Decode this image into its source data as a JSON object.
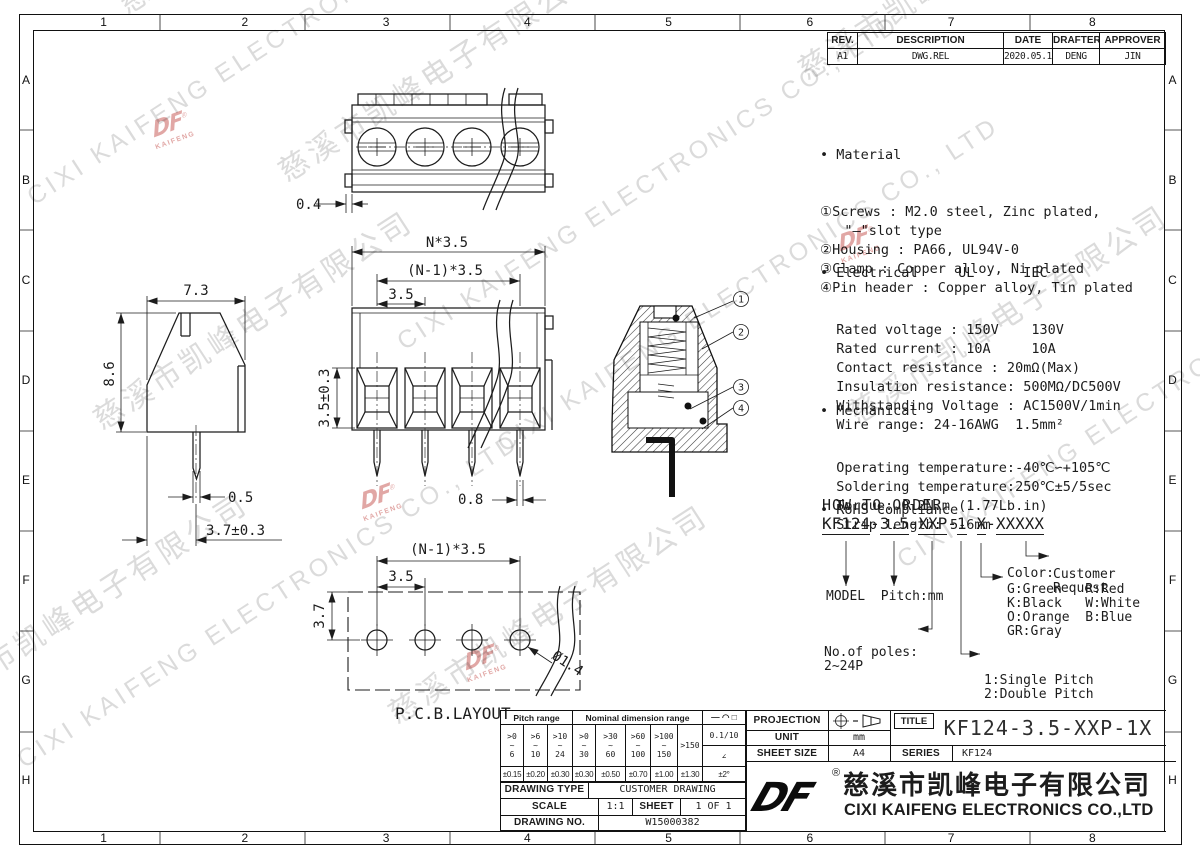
{
  "zones": {
    "cols": [
      "1",
      "2",
      "3",
      "4",
      "5",
      "6",
      "7",
      "8"
    ],
    "rows": [
      "A",
      "B",
      "C",
      "D",
      "E",
      "F",
      "G",
      "H"
    ]
  },
  "revision_table": {
    "headers": [
      "REV.",
      "DESCRIPTION",
      "DATE",
      "DRAFTER",
      "APPROVER"
    ],
    "row": [
      "A1",
      "DWG.REL",
      "2020.05.19",
      "DENG",
      "JIN"
    ]
  },
  "notes": {
    "material": {
      "title": "• Material",
      "lines": [
        "①Screws : M2.0 steel, Zinc plated,",
        "   \"—\"slot type",
        "②Housing : PA66, UL94V-0",
        "③Clamp : Copper alloy, Ni plated",
        "④Pin header : Copper alloy, Tin plated"
      ]
    },
    "electrical": {
      "title": "• Electrical     UL      IEC",
      "lines": [
        "  Rated voltage : 150V    130V",
        "  Rated current : 10A     10A",
        "  Contact resistance : 20mΩ(Max)",
        "  Insulation resistance: 500MΩ/DC500V",
        "  Withstanding Voltage : AC1500V/1min",
        "  Wire range: 24-16AWG  1.5mm²"
      ]
    },
    "mechanical": {
      "title": "• Mechanical",
      "lines": [
        "  Operating temperature:-40℃∽+105℃",
        "  Soldering temperature:250℃±5/5sec",
        "  Torque: 0.2N.m (1.77Lb.in)",
        "  Strip length: 5-6mm"
      ]
    },
    "rohs": "• RoHS compliance"
  },
  "how_to_order": {
    "title": "HOW TO ORDER",
    "code": [
      "KF124",
      "-",
      "3.5",
      "-",
      "XXP",
      "-",
      "1",
      "X",
      "-",
      "XXXXX"
    ],
    "model_pitch": "MODEL  Pitch:mm",
    "poles_line1": "No.of poles:",
    "poles_line2": "2~24P",
    "pitch_line1": "1:Single Pitch",
    "pitch_line2": "2:Double Pitch",
    "color_title": "Color:",
    "color_lines": [
      "G:Green   R:Red",
      "K:Black   W:White",
      "O:Orange  B:Blue",
      "GR:Gray"
    ],
    "customer_line1": "Customer",
    "customer_line2": "Request"
  },
  "dims": {
    "tab_offset": "0.4",
    "total_pitch": "N*3.5",
    "inner_pitch": "(N-1)*3.5",
    "pitch": "3.5",
    "opening": "3.5±0.3",
    "pin_front": "0.8",
    "side_width": "7.3",
    "side_height": "8.6",
    "pin_side": "0.5",
    "pin_offset": "3.7±0.3",
    "pcb_inner_pitch": "(N-1)*3.5",
    "pcb_pitch": "3.5",
    "pcb_row": "3.7",
    "pcb_hole": "Ø1.4",
    "pcb_label": "P.C.B.LAYOUT"
  },
  "callouts": [
    "1",
    "2",
    "3",
    "4"
  ],
  "tolerance_table": {
    "pitch_header": "Pitch range",
    "nominal_header": "Nominal dimension range",
    "symbols": "— ◠ □",
    "pitch": [
      ">0\n~\n6",
      ">6\n~\n10",
      ">10\n~\n24"
    ],
    "nominal": [
      ">0\n~\n30",
      ">30\n~\n60",
      ">60\n~\n100",
      ">100\n~\n150"
    ],
    "over": ">150",
    "frac": "0.1/10",
    "angle": "∠",
    "tol": [
      "±0.15",
      "±0.20",
      "±0.30",
      "±0.30",
      "±0.50",
      "±0.70",
      "±1.00",
      "±1.30"
    ],
    "angle_tol": "±2°",
    "drawing_type_label": "DRAWING TYPE",
    "drawing_type": "CUSTOMER DRAWING",
    "scale_label": "SCALE",
    "scale": "1:1",
    "sheet_label": "SHEET",
    "sheet": "1 OF 1",
    "drawing_no_label": "DRAWING NO.",
    "drawing_no": "W15000382"
  },
  "title_block": {
    "projection_label": "PROJECTION",
    "unit_label": "UNIT",
    "unit": "mm",
    "sheet_size_label": "SHEET SIZE",
    "sheet_size": "A4",
    "title_label": "TITLE",
    "title": "KF124-3.5-XXP-1X",
    "series_label": "SERIES",
    "series": "KF124",
    "logo_text": "DF",
    "reg_mark": "®",
    "company_zh": "慈溪市凯峰电子有限公司",
    "company_en": "CIXI KAIFENG ELECTRONICS CO.,LTD"
  },
  "watermarks": {
    "zh": "慈溪市凯峰电子有限公司",
    "en": "CIXI KAIFENG ELECTRONICS CO., LTD",
    "stamp_top": "DF",
    "stamp_bottom": "KAIFENG",
    "stamp_reg": "®"
  }
}
